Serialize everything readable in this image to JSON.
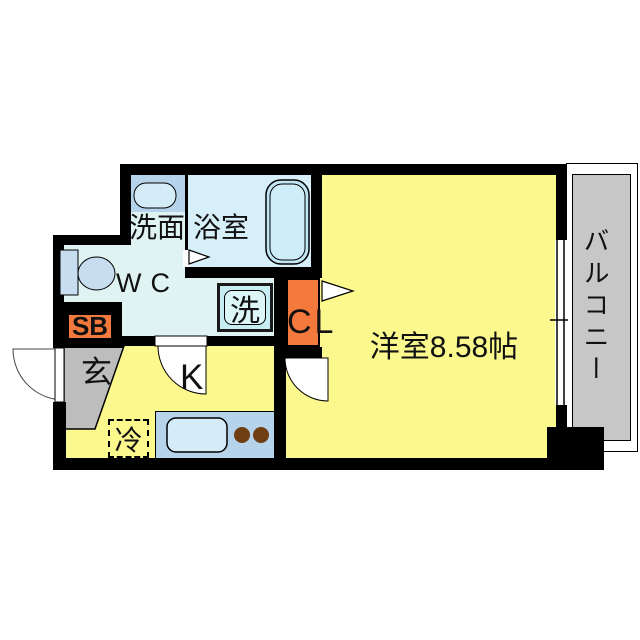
{
  "floorplan": {
    "type": "apartment-floor-plan",
    "rooms": {
      "washroom": {
        "label": "洗面"
      },
      "bathroom": {
        "label": "浴室"
      },
      "wc": {
        "label": "WC"
      },
      "washer_pad": {
        "label": "洗"
      },
      "closet": {
        "label": "CL"
      },
      "western_room": {
        "label": "洋室8.58帖",
        "area_jo": "8.58"
      },
      "balcony": {
        "label": "バルコニー"
      },
      "shoe_box": {
        "label": "SB"
      },
      "entrance": {
        "label": "玄"
      },
      "kitchen": {
        "label": "K"
      },
      "refrigerator": {
        "label": "冷"
      }
    },
    "colors": {
      "wall": "#000000",
      "room_yellow": "#FBF98E",
      "hall_cyan": "#DFF4F2",
      "bath_blue": "#D7EFF9",
      "fixture_blue": "#B5D4EC",
      "sink_blue": "#D3ECF8",
      "tub_blue": "#C2E6F4",
      "washer_blue": "#C6EDF1",
      "toilet_blue": "#C6DEF0",
      "accent_orange": "#F4793C",
      "entrance_gray": "#BDBDBD",
      "balcony_gray": "#C7C7C7",
      "burner_brown": "#6F3E13"
    }
  }
}
